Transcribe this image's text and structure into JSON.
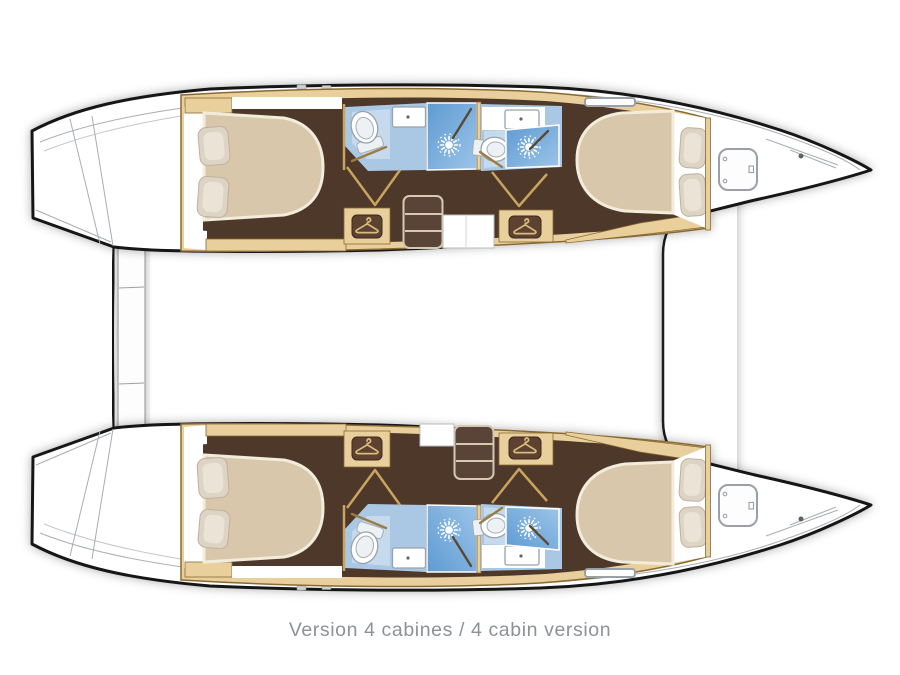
{
  "page": {
    "width": 900,
    "height": 675,
    "background": "#ffffff",
    "caption": "Version 4 cabines / 4 cabin version"
  },
  "plan": {
    "type": "catamaran-floor-plan-top-view",
    "orientation": "bows pointing right",
    "hulls": [
      {
        "name": "port-hull",
        "rooms": [
          "aft-double-cabin",
          "aft-bathroom-with-shower",
          "forward-bathroom-with-shower",
          "forward-double-cabin",
          "bow-anchor-locker"
        ],
        "furniture": [
          "double-bed-with-2-pillows",
          "wardrobe",
          "wardrobe",
          "companionway-stairs",
          "toilet",
          "toilet",
          "sink",
          "sink",
          "shower-stall",
          "shower-stall",
          "deck-hatch",
          "transom-steps"
        ]
      },
      {
        "name": "starboard-hull",
        "rooms": [
          "aft-double-cabin",
          "aft-bathroom-with-shower",
          "forward-bathroom-with-shower",
          "forward-double-cabin",
          "bow-anchor-locker"
        ],
        "furniture": [
          "double-bed-with-2-pillows",
          "wardrobe",
          "wardrobe",
          "companionway-stairs",
          "toilet",
          "toilet",
          "sink",
          "sink",
          "shower-stall",
          "shower-stall",
          "deck-hatch",
          "transom-steps"
        ]
      }
    ],
    "between_hulls": [
      "stern-platform",
      "bridgedeck-bow-outline"
    ],
    "icons": [
      "hanger-icon",
      "shower-spray-icon",
      "toilet-icon",
      "sink-icon",
      "deck-hatch-icon",
      "stairs-icon"
    ]
  },
  "colors": {
    "hull_outline": "#161616",
    "deck_line": "#aaaeb3",
    "wood": "#e9cf9b",
    "wood_dark": "#8a6a33",
    "wood_line": "#c9a45f",
    "floor": "#4e372a",
    "bed": "#d8c7aa",
    "bed_edge": "#f2ecdb",
    "pillow": "#ddd4c5",
    "bath_floor": "#aac7e3",
    "bath_panel": "#c6daee",
    "shower_dark": "#5e9bd3",
    "shower_light": "#9cc4e8",
    "porcelain_line": "#98a2ac",
    "wardrobe_box": "#5d4332",
    "hanger": "#dcbc7e",
    "stairs": "#5a4437",
    "step_border": "#d6c9b4",
    "panel_line": "#b9bdc2",
    "caption": "#8c9298"
  }
}
